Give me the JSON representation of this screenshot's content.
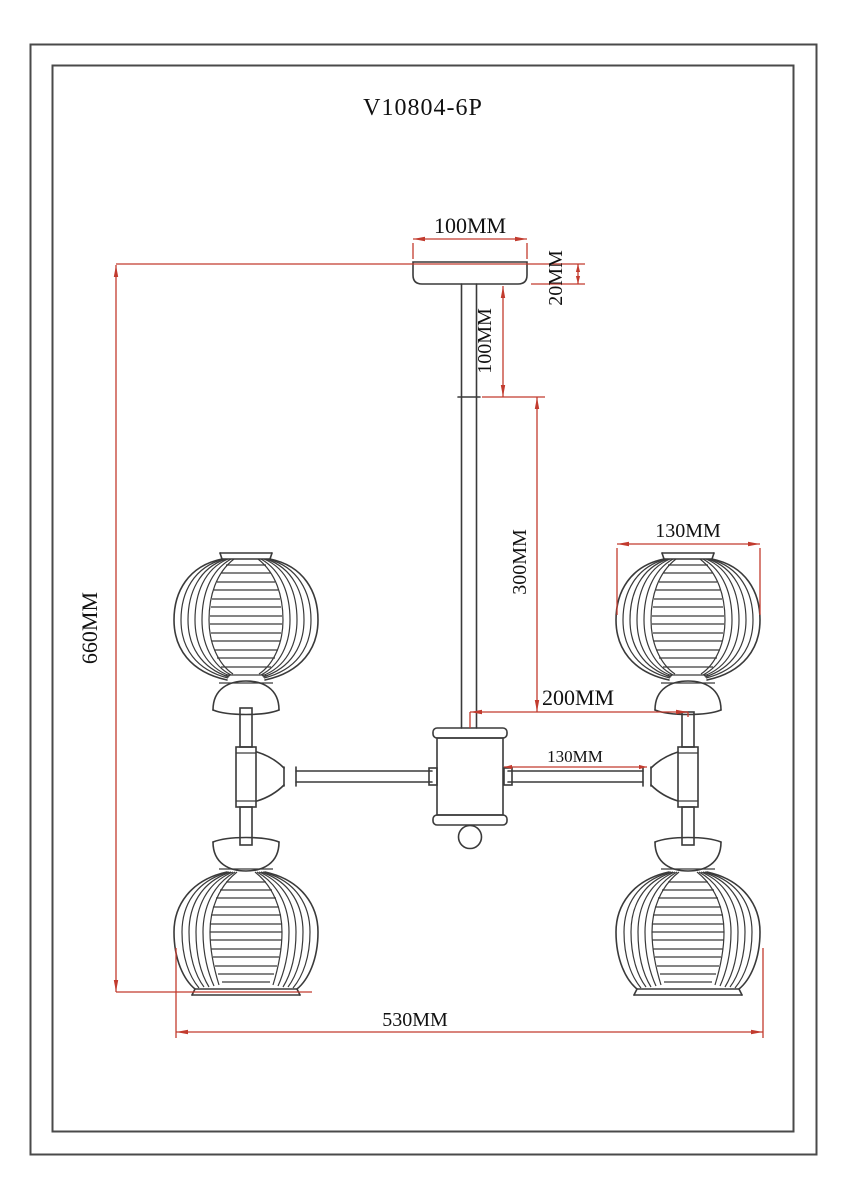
{
  "header": {
    "title": "V10804-6P"
  },
  "diagram": {
    "kind": "lighting-fixture-technical-drawing",
    "dims": {
      "canopy_width": "100MM",
      "canopy_height": "20MM",
      "rod_upper": "100MM",
      "rod_lower": "300MM",
      "center_to_lamp": "200MM",
      "arm_length": "130MM",
      "shade_diameter": "130MM",
      "overall_height": "660MM",
      "overall_width": "530MM"
    },
    "colors": {
      "dimension_line": "#c23b2e",
      "drawing_line": "#3a3a3a",
      "text": "#111111"
    }
  }
}
